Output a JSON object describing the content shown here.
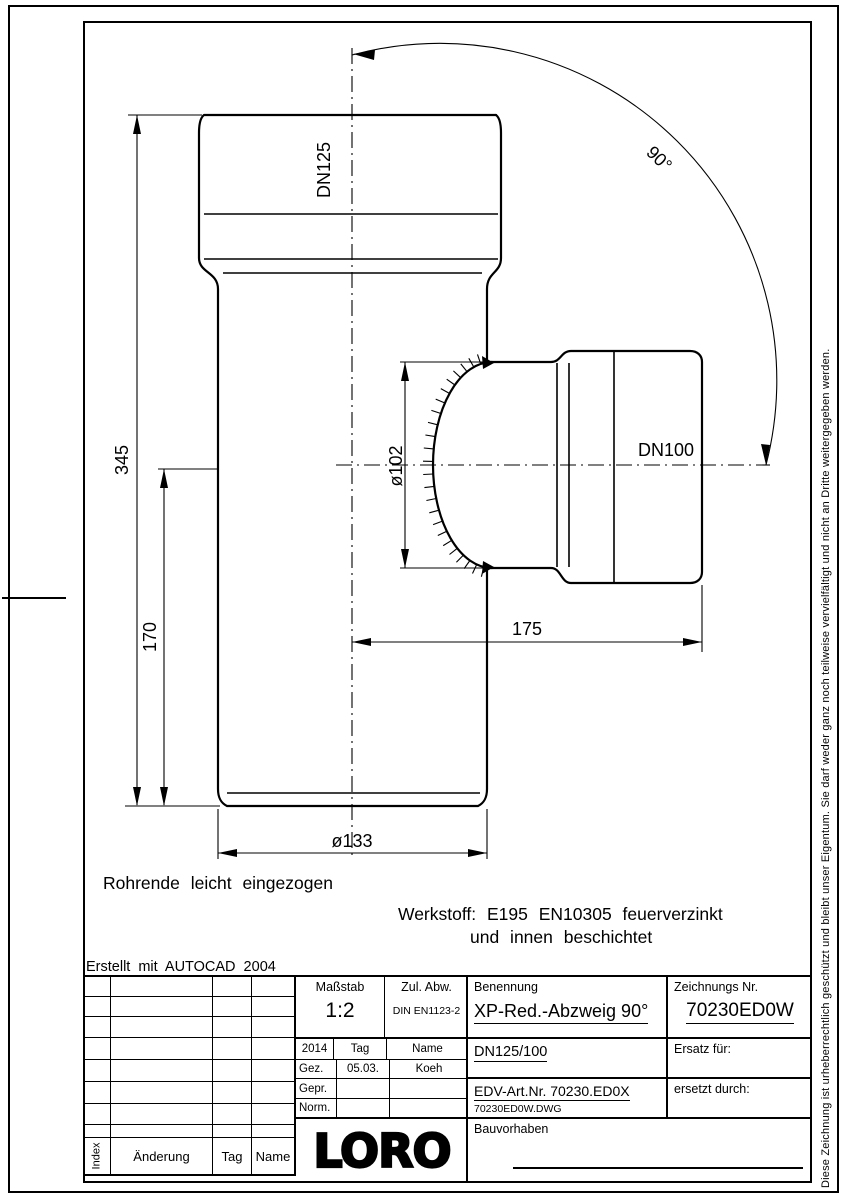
{
  "page": {
    "copyright_vertical": "Diese Zeichnung ist urheberrechtlich geschützt und bleibt unser Eigentum. Sie darf weder ganz noch teilweise vervielfältigt und nicht an Dritte weitergegeben werden.",
    "created_with": "Erstellt mit AUTOCAD 2004"
  },
  "colors": {
    "line": "#000000",
    "background": "#ffffff"
  },
  "drawing": {
    "labels": {
      "dn_top": "DN125",
      "dn_branch": "DN100",
      "dia_branch": "ø102",
      "dia_bottom": "ø133",
      "len_total": "345",
      "len_lower": "170",
      "len_branch": "175",
      "angle": "90°"
    },
    "notes": {
      "pipe_end": "Rohrende leicht eingezogen",
      "material_line1": "Werkstoff: E195 EN10305 feuerverzinkt",
      "material_line2": "und innen beschichtet"
    }
  },
  "titleblock": {
    "masstab_label": "Maßstab",
    "masstab_value": "1:2",
    "zul_abw_label": "Zul. Abw.",
    "zul_abw_value": "DIN EN1123-2",
    "year": "2014",
    "tag_label": "Tag",
    "name_label": "Name",
    "gez_label": "Gez.",
    "gez_tag": "05.03.",
    "gez_name": "Koeh",
    "gepr_label": "Gepr.",
    "norm_label": "Norm.",
    "benennung_label": "Benennung",
    "benennung_value": "XP-Red.-Abzweig 90°",
    "zeichnungs_label": "Zeichnungs Nr.",
    "zeichnungs_value": "70230ED0W",
    "variant": "DN125/100",
    "ersatz_label": "Ersatz für:",
    "edv_art": "EDV-Art.Nr. 70230.ED0X",
    "dwg_file": "70230ED0W.DWG",
    "ersetzt_label": "ersetzt durch:",
    "bauvorhaben_label": "Bauvorhaben",
    "index_label": "Index",
    "aenderung_label": "Änderung",
    "tag_col": "Tag",
    "name_col": "Name",
    "logo": "LORO"
  }
}
